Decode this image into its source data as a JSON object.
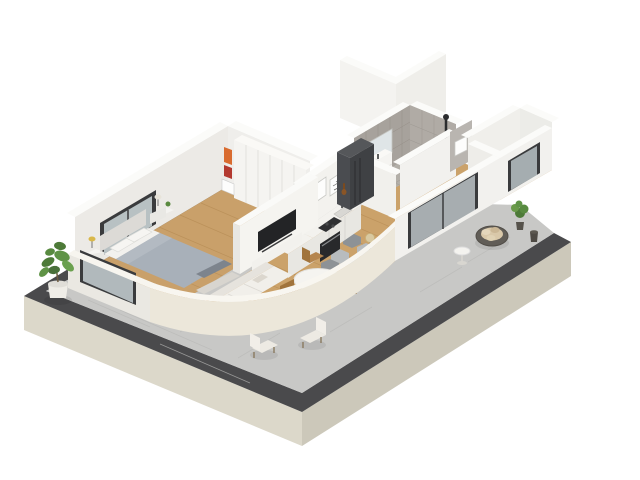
{
  "scene": {
    "type": "isometric-3d-floor-plan-render",
    "background": "#ffffff",
    "palette": {
      "plinth_sw": "#dcd8ca",
      "plinth_se": "#ccc8ba",
      "parapet_band": "#4a4a4c",
      "outdoor_tile": "#c8c8c6",
      "outdoor_tile_line": "#b9b9b7",
      "wood_floor": "#c9a06a",
      "wood_floor_living": "#cba26a",
      "plank_line": "#b68c55",
      "wall_white": "#f2f1ee",
      "wall_top": "#fbfbf9",
      "wall_inner_shaded": "#eceae6",
      "bathroom_tile_wall": "#a7a29c",
      "bathroom_tile_wall2": "#b0aba5",
      "bathroom_floor": "#b3afa8",
      "curved_wall": "#ece7da",
      "curved_wall_top": "#f8f6f0",
      "glass_frame": "#3a3b3d",
      "glass": "#c3cbcd",
      "tv_screen": "#232426",
      "fridge_front": "#3f4144",
      "counter_white": "#f3f2ee",
      "counter_front": "#e8e7e2",
      "cooktop": "#2f3032",
      "oven": "#28292b",
      "dark_counter": "#3a3b3d",
      "sofa": "#f1efea",
      "bed_duvet": "#a8b0b9",
      "bed_duvet_stripe": "#b3bac2",
      "headboard": "#dcdad6",
      "pillow": "#f6f5f2",
      "dining_table": "#f5f4f0",
      "chair_wood": "#b5854e",
      "wicker": "#615d57",
      "wicker_cushion": "#d9c8a9",
      "armchair": "#edeae3",
      "plant_green": "#5f9346",
      "plant_green_dark": "#4d7a38",
      "pot_white": "#efede7",
      "pot_dark": "#56524b",
      "hex_tile_a": "#9fa5a8",
      "hex_tile_b": "#b8bcbe",
      "hex_tile_c": "#8d9296"
    },
    "rooms": [
      {
        "name": "bedroom",
        "floor": "wood",
        "objects": [
          "double-bed",
          "gray-duvet",
          "pillows",
          "headboard",
          "nightstand-left",
          "nightstand-right",
          "table-lamp",
          "wardrobe",
          "shelf-with-books",
          "foot-bench",
          "glass-slider-west"
        ]
      },
      {
        "name": "living-dining",
        "floor": "wood-with-hex-tile-transition",
        "objects": [
          "sofa",
          "tv-partition-wall",
          "wall-tv",
          "media-console",
          "round-dining-table",
          "dining-chair-x3",
          "sphere-floor-lamp",
          "art-frame-x2"
        ]
      },
      {
        "name": "kitchen",
        "floor": "wood",
        "objects": [
          "l-shaped-counter",
          "cooktop",
          "oven",
          "sink",
          "faucet",
          "refrigerator",
          "bottle"
        ]
      },
      {
        "name": "bathroom",
        "floor": "gray-tile",
        "objects": [
          "vanity-with-sink",
          "mirror",
          "toilet",
          "shower-column"
        ]
      },
      {
        "name": "hallway",
        "floor": "wood",
        "objects": [
          "art-frame",
          "black-floor-lamp"
        ]
      },
      {
        "name": "study-nook",
        "floor": "wood",
        "objects": [
          "dark-desk-counter",
          "desk-objects",
          "glass-door"
        ]
      },
      {
        "name": "balcony",
        "floor": "stone-tile",
        "objects": [
          "round-wicker-chair",
          "cushions",
          "side-table",
          "potted-plant",
          "dark-planter",
          "glass-slider"
        ]
      },
      {
        "name": "terrace",
        "floor": "stone-tile",
        "objects": [
          "armchair-1",
          "armchair-2",
          "fiddle-leaf-plant",
          "charcoal-parapet-band",
          "beige-plinth"
        ]
      }
    ]
  }
}
